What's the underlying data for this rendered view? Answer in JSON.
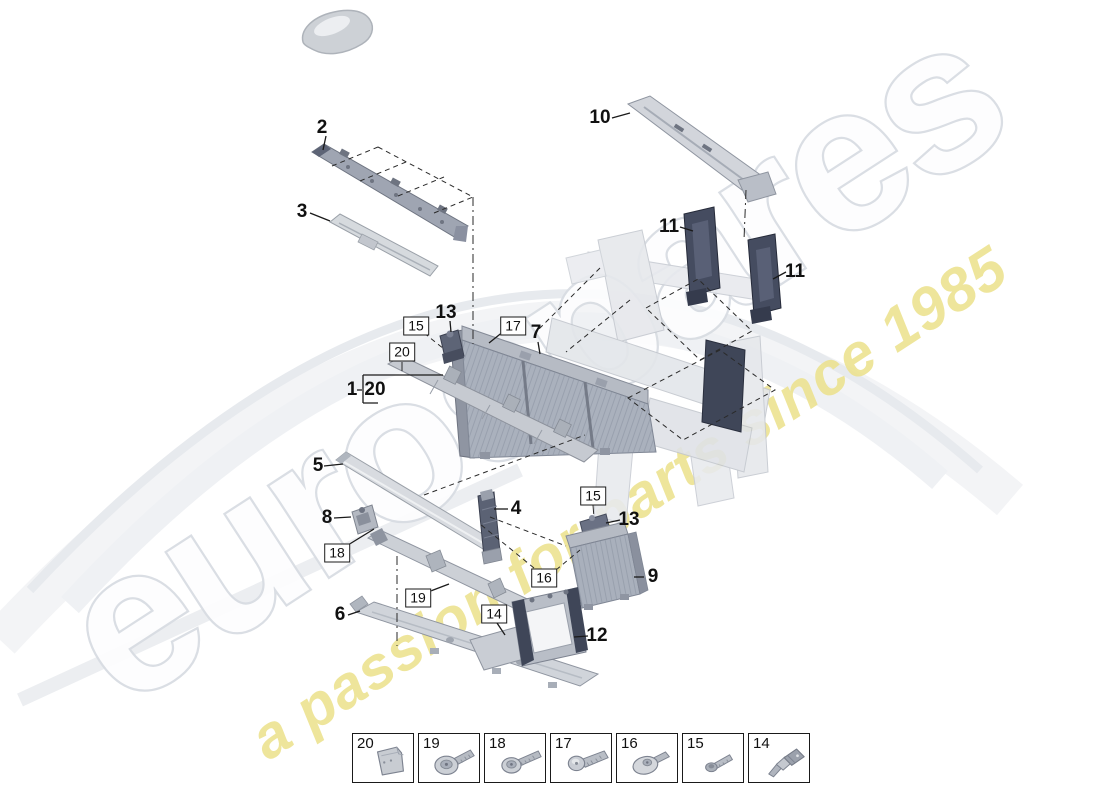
{
  "watermark": {
    "brand": "eurospares",
    "tagline": "a passion for parts since 1985",
    "brand_fill": "#fdfdfe",
    "brand_outline": "#d9dde3",
    "tagline_color": "#ece28e"
  },
  "labels": [
    {
      "text": "2",
      "x": 322,
      "y": 128,
      "style": "plain"
    },
    {
      "text": "3",
      "x": 302,
      "y": 212,
      "style": "plain"
    },
    {
      "text": "10",
      "x": 600,
      "y": 118,
      "style": "plain"
    },
    {
      "text": "11",
      "x": 669,
      "y": 227,
      "style": "plain"
    },
    {
      "text": "11",
      "x": 795,
      "y": 272,
      "style": "plain"
    },
    {
      "text": "13",
      "x": 446,
      "y": 313,
      "style": "plain"
    },
    {
      "text": "7",
      "x": 536,
      "y": 333,
      "style": "plain"
    },
    {
      "text": "1",
      "x": 352,
      "y": 390,
      "style": "plain"
    },
    {
      "text": "20",
      "x": 375,
      "y": 390,
      "style": "plain"
    },
    {
      "text": "5",
      "x": 318,
      "y": 466,
      "style": "plain"
    },
    {
      "text": "8",
      "x": 327,
      "y": 518,
      "style": "plain"
    },
    {
      "text": "6",
      "x": 340,
      "y": 615,
      "style": "plain"
    },
    {
      "text": "4",
      "x": 516,
      "y": 509,
      "style": "plain"
    },
    {
      "text": "13",
      "x": 629,
      "y": 520,
      "style": "plain"
    },
    {
      "text": "9",
      "x": 653,
      "y": 577,
      "style": "plain"
    },
    {
      "text": "12",
      "x": 597,
      "y": 636,
      "style": "plain"
    },
    {
      "text": "15",
      "x": 416,
      "y": 326,
      "style": "boxed"
    },
    {
      "text": "17",
      "x": 513,
      "y": 326,
      "style": "boxed"
    },
    {
      "text": "20",
      "x": 402,
      "y": 352,
      "style": "boxed"
    },
    {
      "text": "18",
      "x": 337,
      "y": 553,
      "style": "boxed"
    },
    {
      "text": "19",
      "x": 418,
      "y": 598,
      "style": "boxed"
    },
    {
      "text": "15",
      "x": 593,
      "y": 496,
      "style": "boxed"
    },
    {
      "text": "16",
      "x": 544,
      "y": 578,
      "style": "boxed"
    },
    {
      "text": "14",
      "x": 494,
      "y": 614,
      "style": "boxed"
    }
  ],
  "fastener_table": {
    "cells": [
      {
        "number": "20",
        "icon": "clip-plate"
      },
      {
        "number": "19",
        "icon": "screw-big-washer"
      },
      {
        "number": "18",
        "icon": "screw-washer"
      },
      {
        "number": "17",
        "icon": "screw-pan"
      },
      {
        "number": "16",
        "icon": "screw-flat-washer"
      },
      {
        "number": "15",
        "icon": "bolt-small"
      },
      {
        "number": "14",
        "icon": "pin-rivet"
      }
    ]
  }
}
